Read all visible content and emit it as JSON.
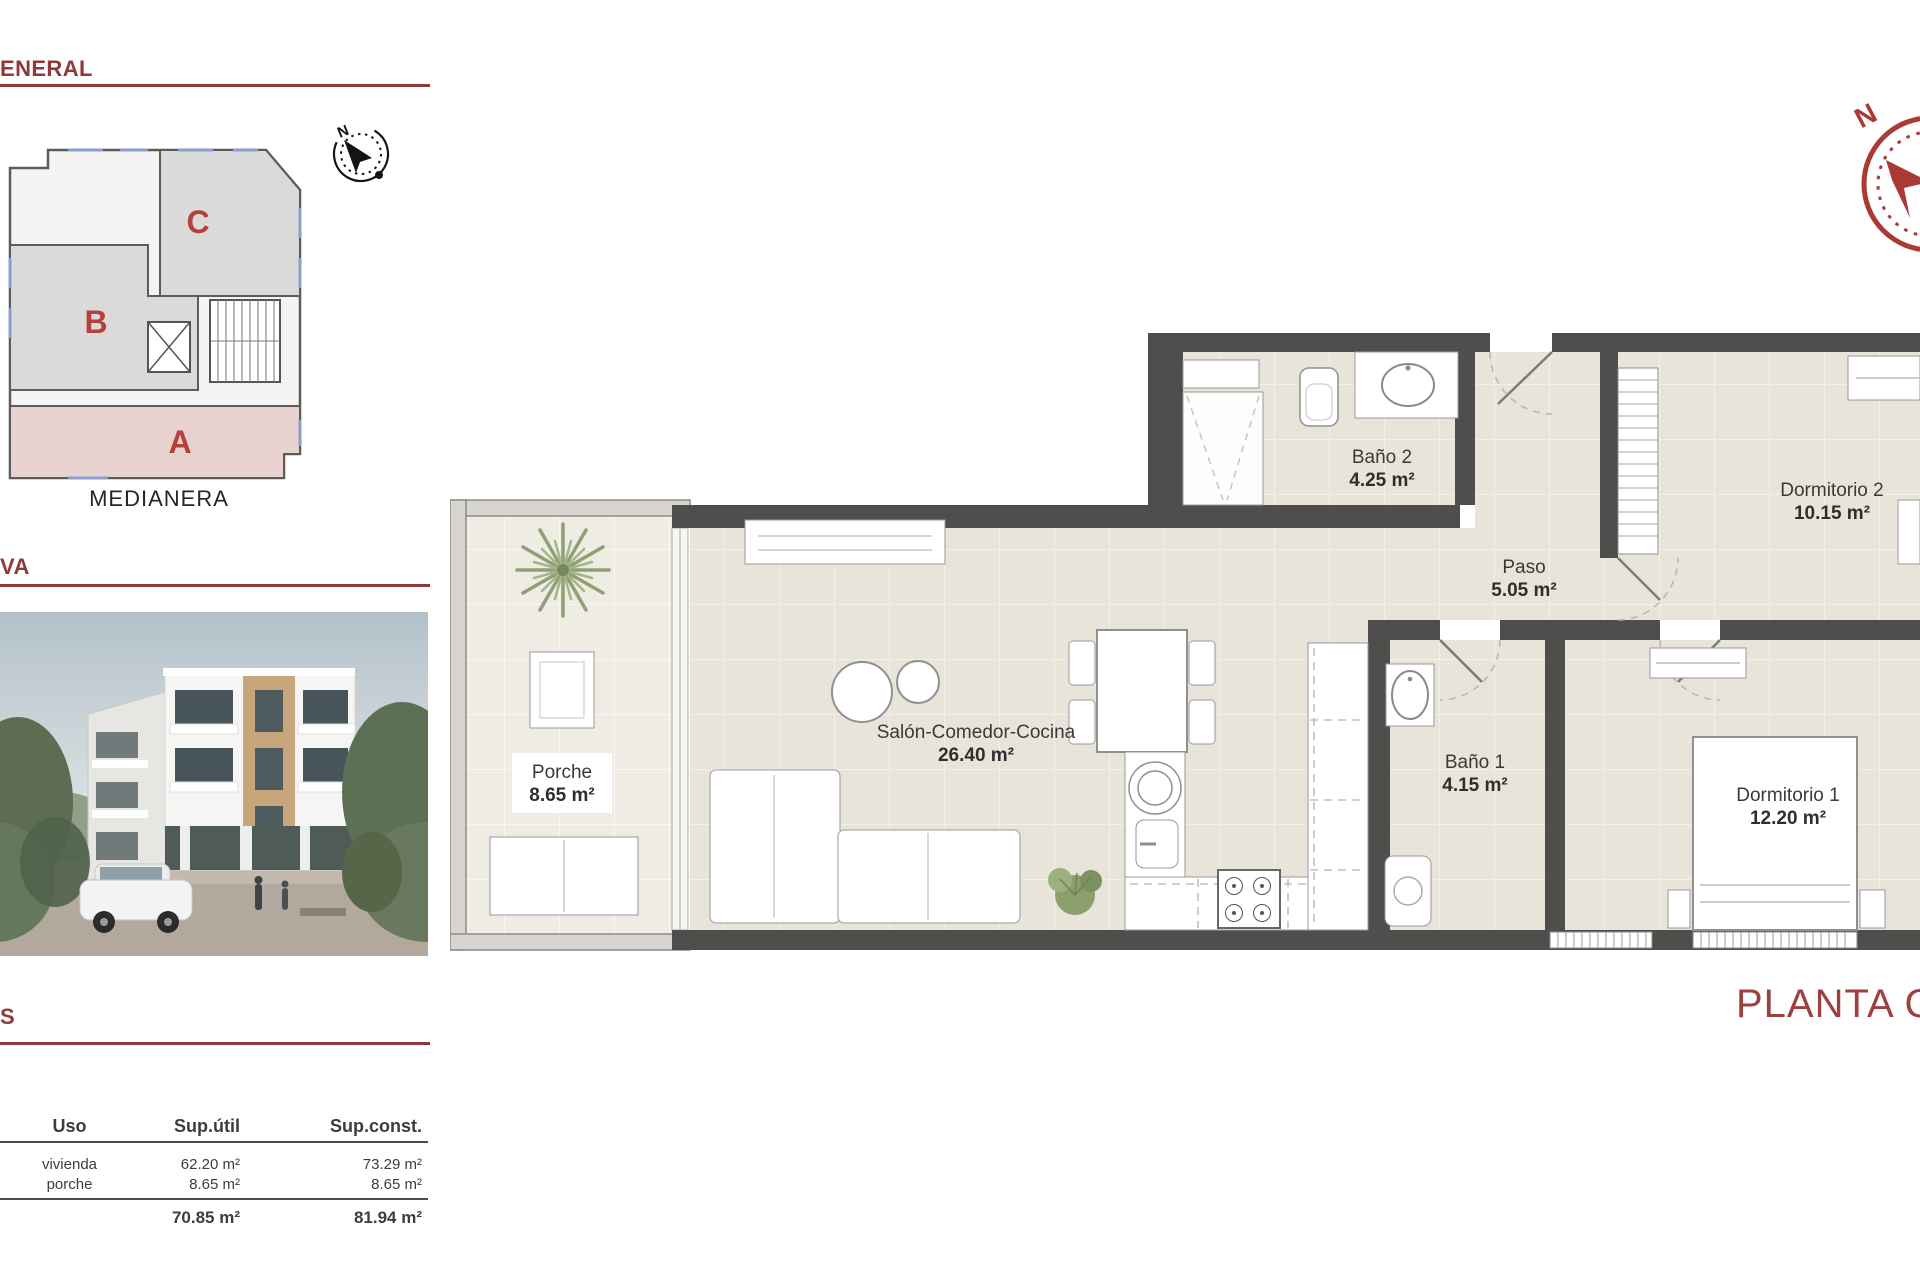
{
  "titles": {
    "general_cut": "ENERAL",
    "render_cut": "VA",
    "table_cut": "S",
    "floor_caption": "PLANTA CUA"
  },
  "site_plan": {
    "units": [
      "C",
      "B",
      "A"
    ],
    "caption": "MEDIANERA",
    "compass_north": "N"
  },
  "compass_rose": {
    "north": "N"
  },
  "floor_plan": {
    "rooms": [
      {
        "name": "Baño 2",
        "area": "4.25 m²"
      },
      {
        "name": "Dormitorio 2",
        "area": "10.15 m²"
      },
      {
        "name": "Paso",
        "area": "5.05 m²"
      },
      {
        "name": "Salón-Comedor-Cocina",
        "area": "26.40 m²"
      },
      {
        "name": "Porche",
        "area": "8.65 m²"
      },
      {
        "name": "Baño 1",
        "area": "4.15 m²"
      },
      {
        "name": "Dormitorio 1",
        "area": "12.20 m²"
      }
    ]
  },
  "surface_table": {
    "headers": [
      "Uso",
      "Sup.útil",
      "Sup.const."
    ],
    "rows": [
      {
        "uso": "vivienda",
        "util": "62.20 m²",
        "const": "73.29 m²"
      },
      {
        "uso": "porche",
        "util": "8.65 m²",
        "const": "8.65 m²"
      }
    ],
    "totals": {
      "util": "70.85 m²",
      "const": "81.94 m²"
    }
  },
  "colors": {
    "accent": "#8e3a3a",
    "wall": "#4f4e4c",
    "floor_tile": "#e9e4da",
    "unit_highlight": "#e7d2d0"
  }
}
